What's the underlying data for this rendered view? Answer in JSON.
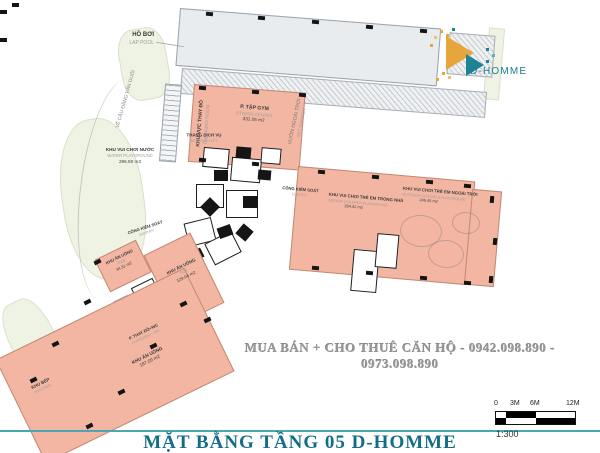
{
  "logo": {
    "brand": "D-HOMME"
  },
  "watermark": "MUA BÁN + CHO THUÊ CĂN HỘ - 0942.098.890 - 0973.098.890",
  "title": "MẶT BẰNG TẦNG 05 D-HOMME",
  "scalebar": {
    "t0": "0",
    "t1": "3M",
    "t2": "6M",
    "t3": "12M",
    "ratio": "1:300"
  },
  "colors": {
    "pink": "#f3b6a3",
    "teal_title": "#126e86",
    "logo_gold": "#e7a63b",
    "logo_teal": "#1e8393"
  },
  "rooms": {
    "pool": {
      "vi": "HỒ BƠI",
      "en": "LAP POOL"
    },
    "gym": {
      "vi": "P. TẬP GYM",
      "en": "FITNESS CENTER",
      "area": "331.05 m2"
    },
    "changing_gym": {
      "vi": "KHU VỰC THAY ĐỒ",
      "en": "CHANGING ROOM"
    },
    "service_lift": {
      "vi": "THANG DỊCH VỤ",
      "en": "SERVICE LIFT"
    },
    "water_play": {
      "vi": "KHU VUI CHƠI NƯỚC",
      "en": "WATER PLAYGROUND",
      "area": "296.50 m2"
    },
    "sky_garden": {
      "vi": "VƯỜN NGOÀI TRỜI",
      "en": "SKY GARDEN"
    },
    "gantry_right": {
      "vi": "CỔNG KIỂM SOÁT",
      "en": "GANTRY"
    },
    "gantry_left": {
      "vi": "CỔNG KIỂM SOÁT",
      "en": "GANTRY"
    },
    "playground_indoor": {
      "vi": "KHU VUI CHƠI TRẺ EM TRONG NHÀ",
      "en": "INDOOR CHILDREN PLAYGROUND",
      "area": "264.42 m2"
    },
    "playground_outdoor": {
      "vi": "KHU VUI CHƠI TRẺ EM NGOÀI TRỜI",
      "en": "OUTDOOR CHILDREN PLAYGROUND",
      "area": "246.45 m2"
    },
    "fb_small": {
      "vi": "KHU ĂN UỐNG",
      "en": "F&B",
      "area": "34.31 m2"
    },
    "fb_mid": {
      "vi": "KHU ĂN UỐNG",
      "en": "F&B",
      "area": "129.04 m2"
    },
    "changing_wc": {
      "vi": "P. THAY ĐỒ+WC",
      "en": "CHANGING + WC"
    },
    "fb_large": {
      "vi": "KHU ĂN UỐNG",
      "area": "187.09 m2"
    },
    "kitchen": {
      "vi": "KHU BẾP",
      "en": "KITCHEN"
    },
    "street": {
      "vi": "VỀ CẦU ĐẶNG VĂN DUỔI"
    }
  }
}
